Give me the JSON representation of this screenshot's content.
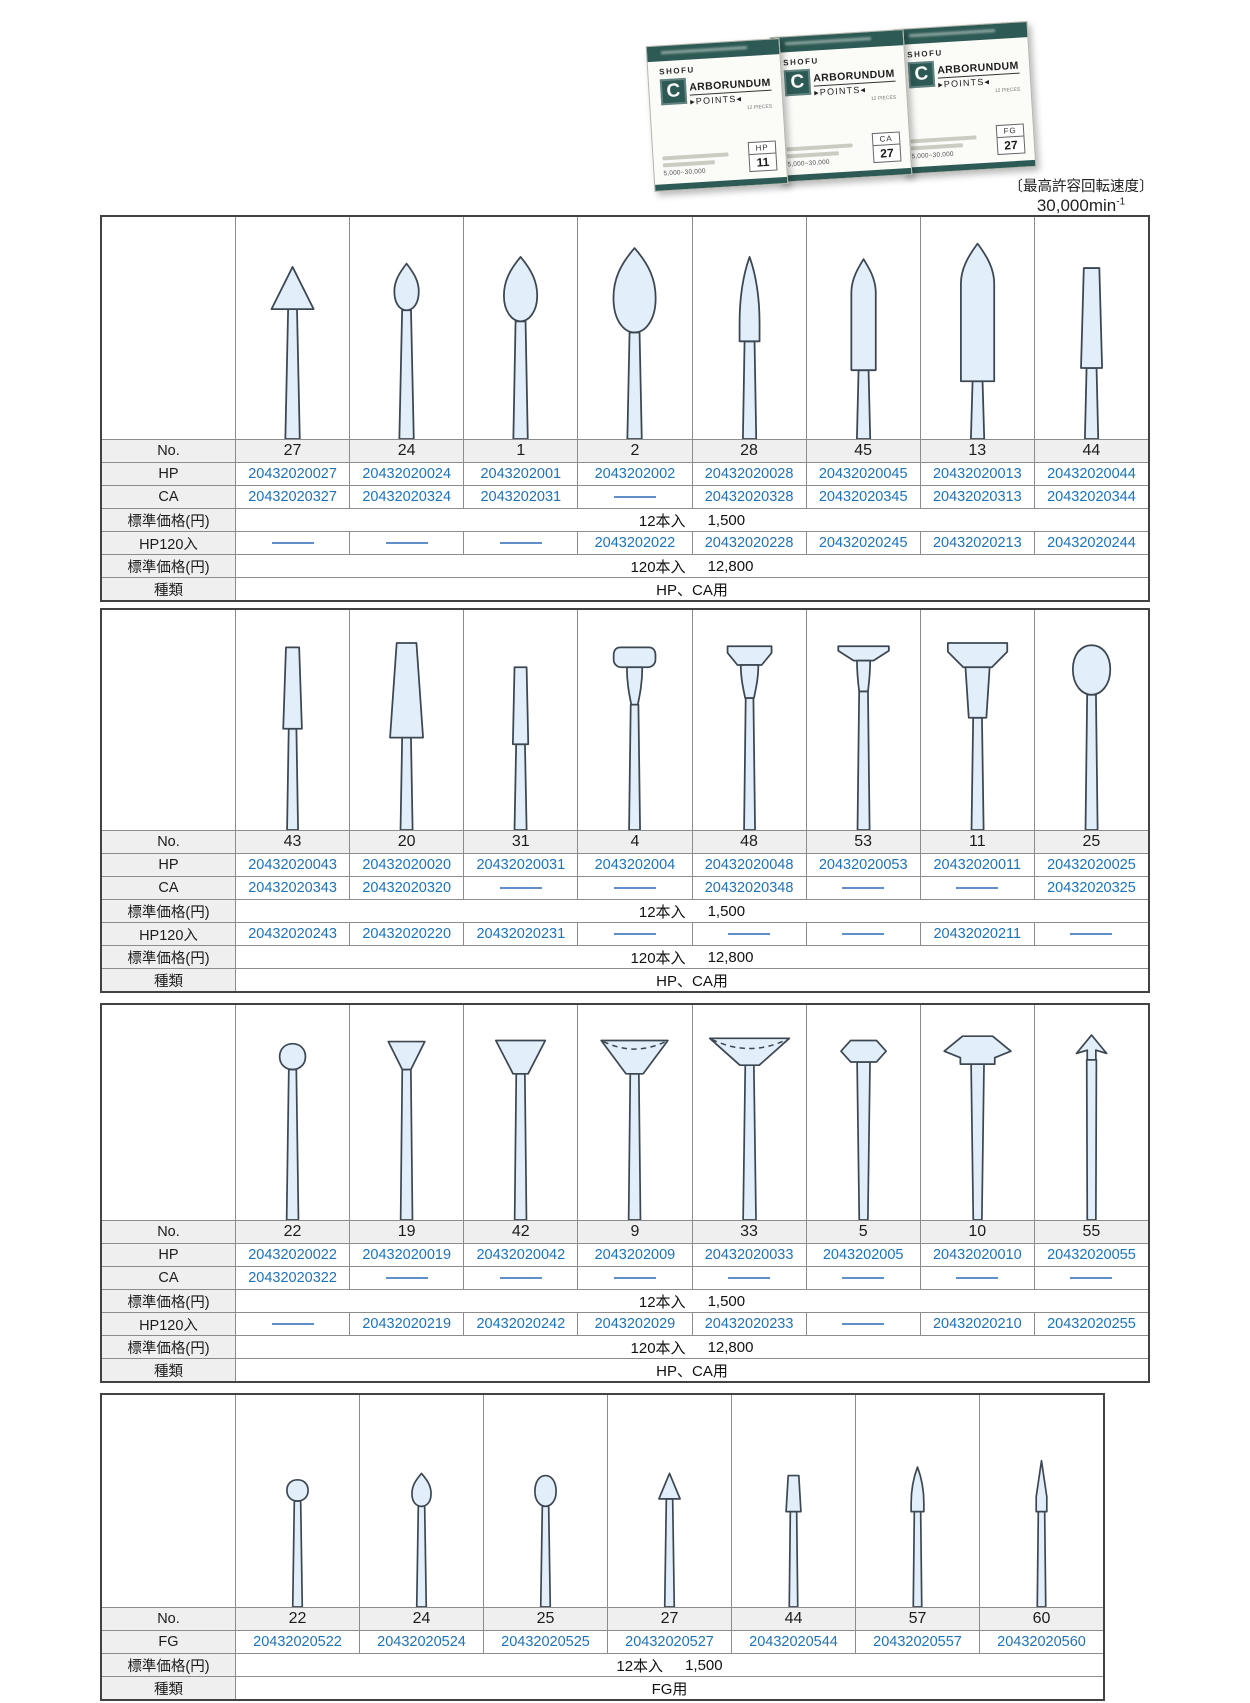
{
  "photo": {
    "boxes": [
      {
        "brand": "SHOFU",
        "logo": "C",
        "name": "ARBORUNDUM",
        "sub": "▸POINTS◂",
        "pieces": "12 PIECES",
        "speed": "5,000~30,000",
        "type": "HP",
        "no": "11"
      },
      {
        "brand": "SHOFU",
        "logo": "C",
        "name": "ARBORUNDUM",
        "sub": "▸POINTS◂",
        "pieces": "12 PIECES",
        "speed": "5,000~30,000",
        "type": "CA",
        "no": "27"
      },
      {
        "brand": "SHOFU",
        "logo": "C",
        "name": "ARBORUNDUM",
        "sub": "▸POINTS◂",
        "pieces": "12 PIECES",
        "speed": "5,000~30,000",
        "type": "FG",
        "no": "27"
      }
    ]
  },
  "caption": {
    "line1": "〔最高許容回転速度〕",
    "value": "30,000min",
    "sup": "-1"
  },
  "colors": {
    "accent_teal": "#2d5a54",
    "code_blue": "#1e72b8",
    "shape_fill": "#e2eefa"
  },
  "tables": [
    {
      "shapes": [
        "cone",
        "budS",
        "budM",
        "budL",
        "taperPoint",
        "bullet",
        "torpedo",
        "taperFlat"
      ],
      "rows": [
        {
          "key": "no",
          "label": "No.",
          "type": "values",
          "values": [
            "27",
            "24",
            "1",
            "2",
            "28",
            "45",
            "13",
            "44"
          ]
        },
        {
          "key": "hp",
          "label": "HP",
          "type": "codes",
          "values": [
            "20432020027",
            "20432020024",
            "2043202001",
            "2043202002",
            "20432020028",
            "20432020045",
            "20432020013",
            "20432020044"
          ]
        },
        {
          "key": "ca",
          "label": "CA",
          "type": "codes",
          "values": [
            "20432020327",
            "20432020324",
            "2043202031",
            null,
            "20432020328",
            "20432020345",
            "20432020313",
            "20432020344"
          ]
        },
        {
          "key": "price12",
          "label": "標準価格(円)",
          "type": "span",
          "qty": "12本入",
          "value": "1,500"
        },
        {
          "key": "hp120",
          "label": "HP120入",
          "type": "codes",
          "values": [
            null,
            null,
            null,
            "2043202022",
            "20432020228",
            "20432020245",
            "20432020213",
            "20432020244"
          ]
        },
        {
          "key": "price120",
          "label": "標準価格(円)",
          "type": "span",
          "qty": "120本入",
          "value": "12,800"
        },
        {
          "key": "kind",
          "label": "種類",
          "type": "span",
          "value": "HP、CA用"
        }
      ]
    },
    {
      "shapes": [
        "tcylS",
        "tcylL",
        "cylS",
        "wheelRound",
        "wheelFlat",
        "wheelThin",
        "wheelLarge",
        "knob"
      ],
      "rows": [
        {
          "key": "no",
          "label": "No.",
          "type": "values",
          "values": [
            "43",
            "20",
            "31",
            "4",
            "48",
            "53",
            "11",
            "25"
          ]
        },
        {
          "key": "hp",
          "label": "HP",
          "type": "codes",
          "values": [
            "20432020043",
            "20432020020",
            "20432020031",
            "2043202004",
            "20432020048",
            "20432020053",
            "20432020011",
            "20432020025"
          ]
        },
        {
          "key": "ca",
          "label": "CA",
          "type": "codes",
          "values": [
            "20432020343",
            "20432020320",
            null,
            null,
            "20432020348",
            null,
            null,
            "20432020325"
          ]
        },
        {
          "key": "price12",
          "label": "標準価格(円)",
          "type": "span",
          "qty": "12本入",
          "value": "1,500"
        },
        {
          "key": "hp120",
          "label": "HP120入",
          "type": "codes",
          "values": [
            "20432020243",
            "20432020220",
            "20432020231",
            null,
            null,
            null,
            "20432020211",
            null
          ]
        },
        {
          "key": "price120",
          "label": "標準価格(円)",
          "type": "span",
          "qty": "120本入",
          "value": "12,800"
        },
        {
          "key": "kind",
          "label": "種類",
          "type": "span",
          "value": "HP、CA用"
        }
      ]
    },
    {
      "shapes": [
        "ball",
        "invConeS",
        "invConeM",
        "cupDash",
        "dishDash",
        "hexKnob",
        "hat",
        "arrow"
      ],
      "rows": [
        {
          "key": "no",
          "label": "No.",
          "type": "values",
          "values": [
            "22",
            "19",
            "42",
            "9",
            "33",
            "5",
            "10",
            "55"
          ]
        },
        {
          "key": "hp",
          "label": "HP",
          "type": "codes",
          "values": [
            "20432020022",
            "20432020019",
            "20432020042",
            "2043202009",
            "20432020033",
            "2043202005",
            "20432020010",
            "20432020055"
          ]
        },
        {
          "key": "ca",
          "label": "CA",
          "type": "codes",
          "values": [
            "20432020322",
            null,
            null,
            null,
            null,
            null,
            null,
            null
          ]
        },
        {
          "key": "price12",
          "label": "標準価格(円)",
          "type": "span",
          "qty": "12本入",
          "value": "1,500"
        },
        {
          "key": "hp120",
          "label": "HP120入",
          "type": "codes",
          "values": [
            null,
            "20432020219",
            "20432020242",
            "2043202029",
            "20432020233",
            null,
            "20432020210",
            "20432020255"
          ]
        },
        {
          "key": "price120",
          "label": "標準価格(円)",
          "type": "span",
          "qty": "120本入",
          "value": "12,800"
        },
        {
          "key": "kind",
          "label": "種類",
          "type": "span",
          "value": "HP、CA用"
        }
      ]
    },
    {
      "shapes": [
        "ballT",
        "budT",
        "eggT",
        "coneT",
        "taperT",
        "slimT",
        "needleT"
      ],
      "rows": [
        {
          "key": "no",
          "label": "No.",
          "type": "values",
          "values": [
            "22",
            "24",
            "25",
            "27",
            "44",
            "57",
            "60"
          ]
        },
        {
          "key": "fg",
          "label": "FG",
          "type": "codes",
          "values": [
            "20432020522",
            "20432020524",
            "20432020525",
            "20432020527",
            "20432020544",
            "20432020557",
            "20432020560"
          ]
        },
        {
          "key": "price12",
          "label": "標準価格(円)",
          "type": "span",
          "qty": "12本入",
          "value": "1,500"
        },
        {
          "key": "kind",
          "label": "種類",
          "type": "span",
          "value": "FG用"
        }
      ]
    }
  ]
}
